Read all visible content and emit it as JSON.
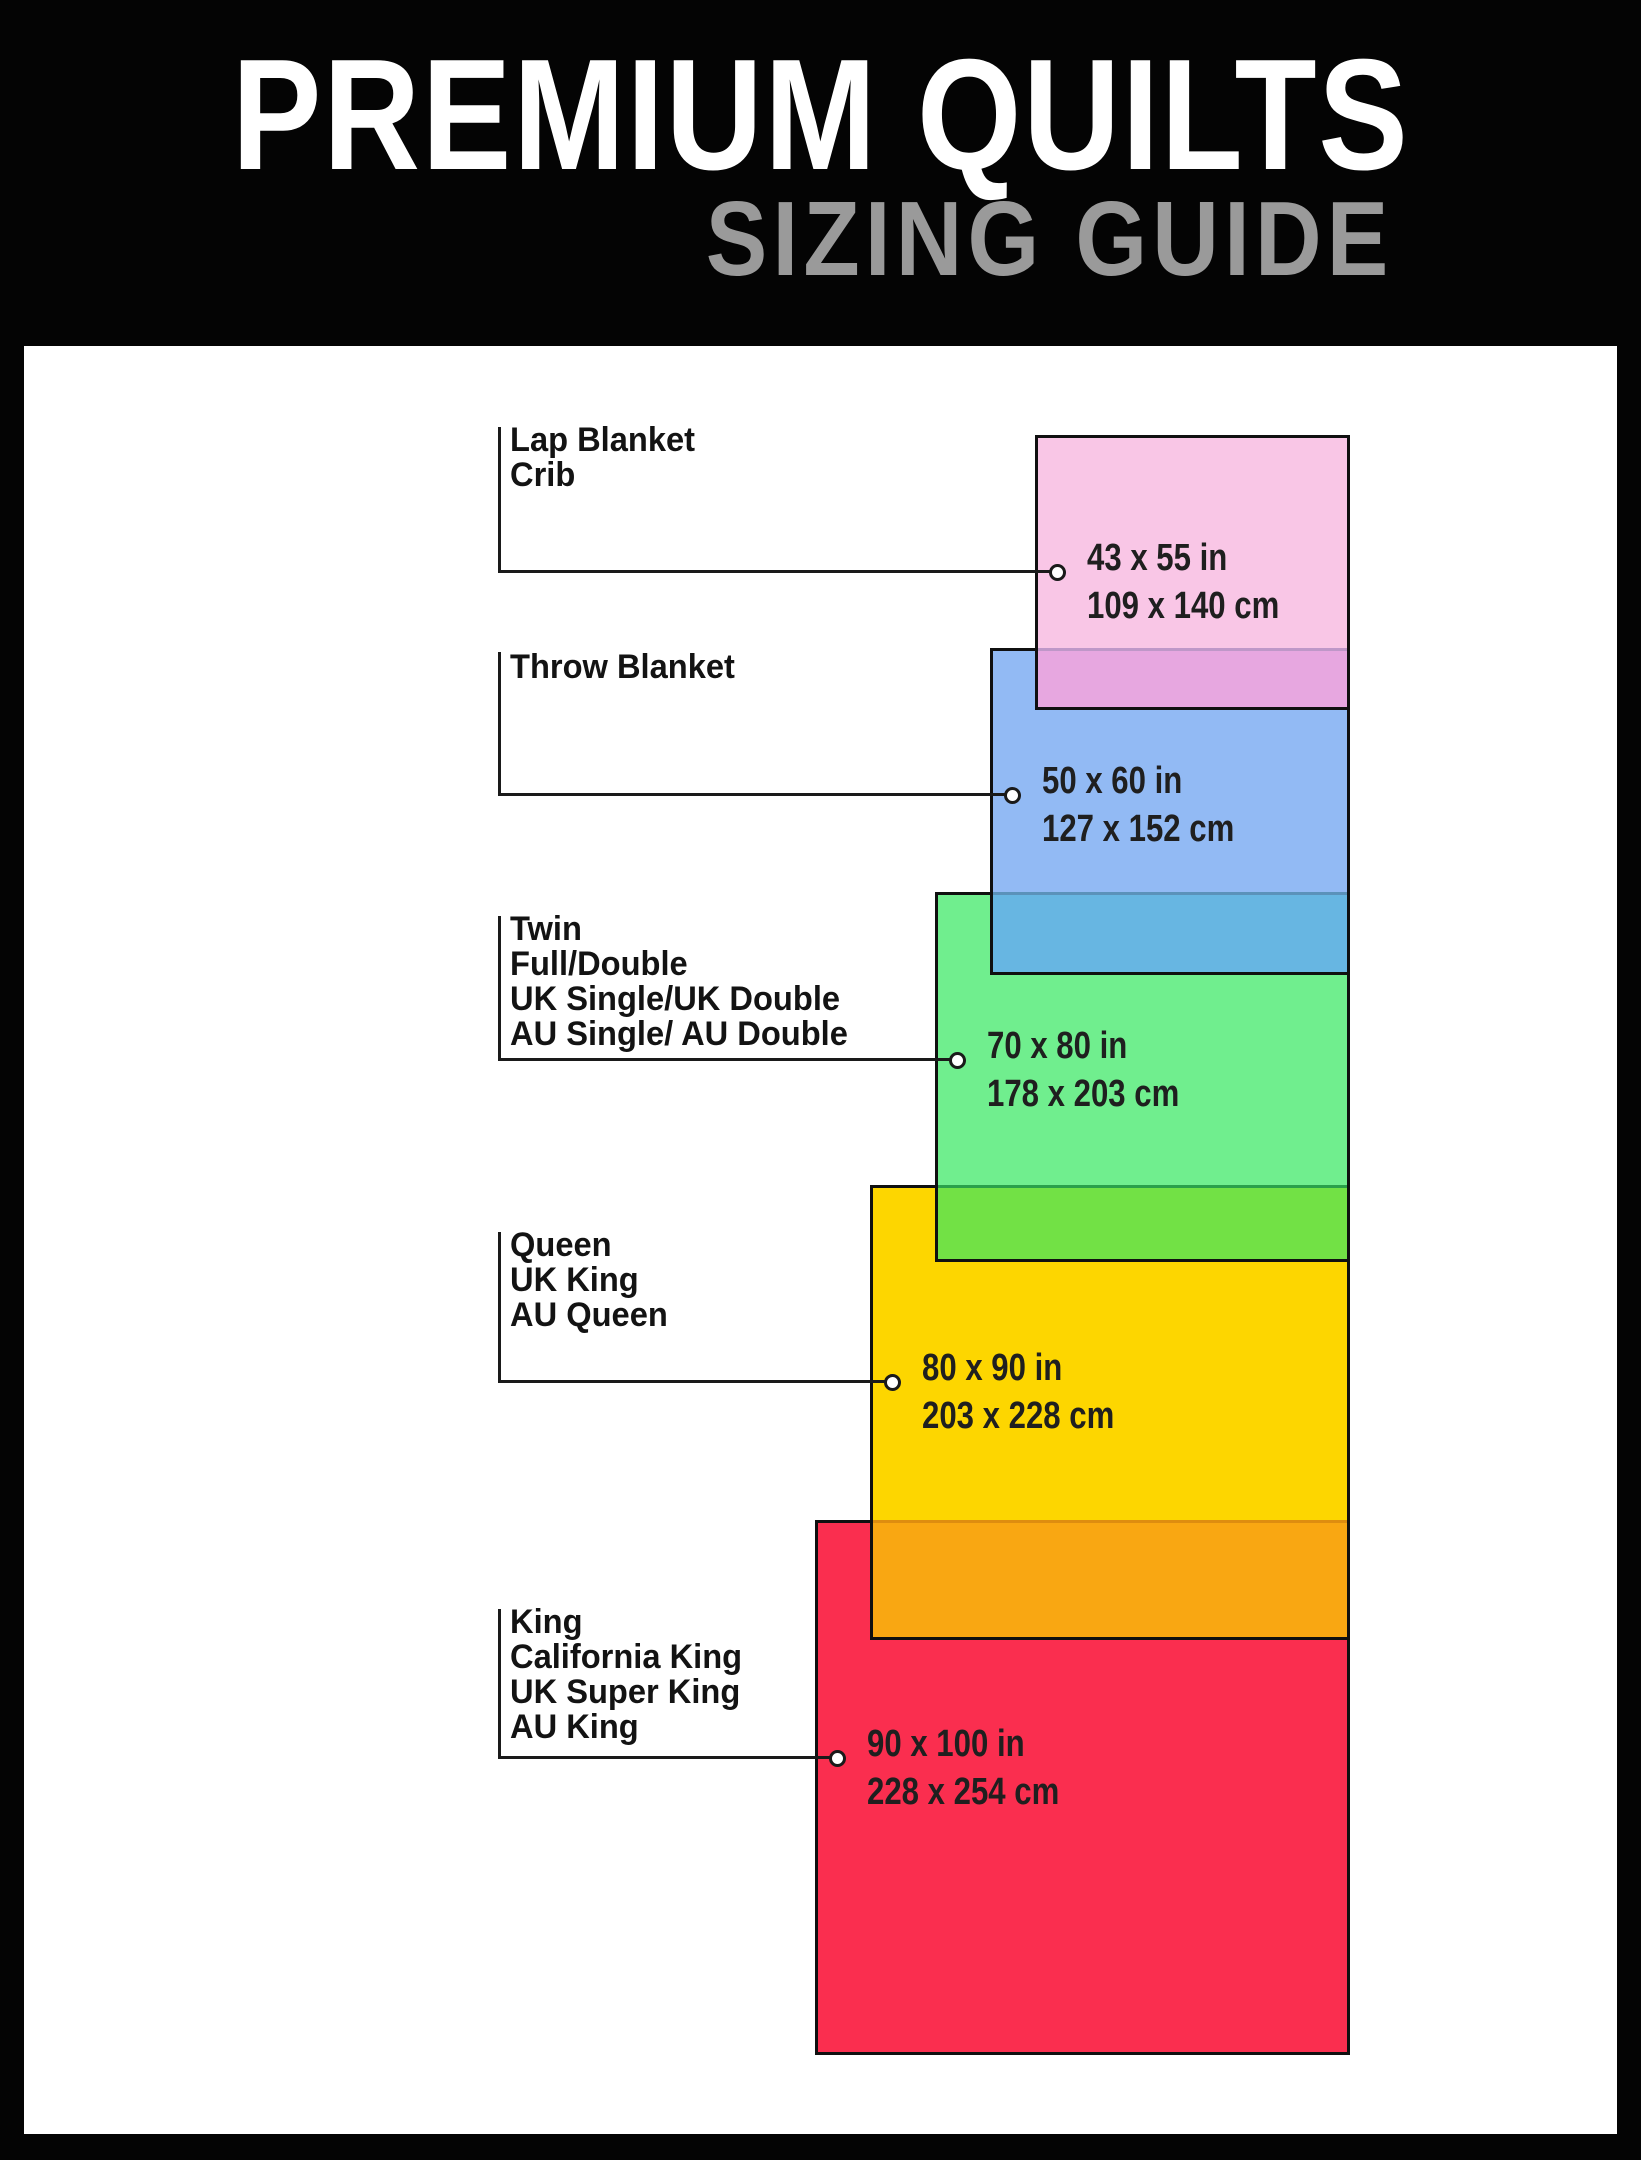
{
  "header": {
    "title": "PREMIUM QUILTS",
    "subtitle": "SIZING GUIDE"
  },
  "palette": {
    "frame_background": "#040404",
    "panel_background": "#ffffff",
    "title_color": "#ffffff",
    "subtitle_color": "#9a9a9a",
    "outline_color": "#101010",
    "connector_color": "#1a1a1a"
  },
  "sizes": [
    {
      "name": "lap-blanket-crib",
      "label_text": "Lap Blanket\nCrib",
      "size_in": "43 x 55 in",
      "size_cm": "109 x 140 cm",
      "fill": "#f9c6e6",
      "overlap_with_next_fill": "#e7a7e0"
    },
    {
      "name": "throw-blanket",
      "label_text": "Throw Blanket",
      "size_in": "50 x 60 in",
      "size_cm": "127 x 152 cm",
      "fill": "#92baf4",
      "overlap_with_next_fill": "#67b6e2"
    },
    {
      "name": "twin-full-double",
      "label_text": "Twin\nFull/Double\nUK Single/UK Double\nAU Single/ AU Double",
      "size_in": "70 x 80 in",
      "size_cm": "178 x 203 cm",
      "fill": "#70ee8e",
      "overlap_with_next_fill": "#72e145"
    },
    {
      "name": "queen-uk-king-au-queen",
      "label_text": "Queen\nUK King\nAU Queen",
      "size_in": "80 x 90 in",
      "size_cm": "203 x 228 cm",
      "fill": "#fdd600",
      "overlap_with_next_fill": "#f9a712"
    },
    {
      "name": "king-california-king",
      "label_text": "King\nCalifornia King\nUK Super King\nAU King",
      "size_in": "90 x 100 in",
      "size_cm": "228 x 254 cm",
      "fill": "#fa2e4f",
      "overlap_with_next_fill": null
    }
  ]
}
